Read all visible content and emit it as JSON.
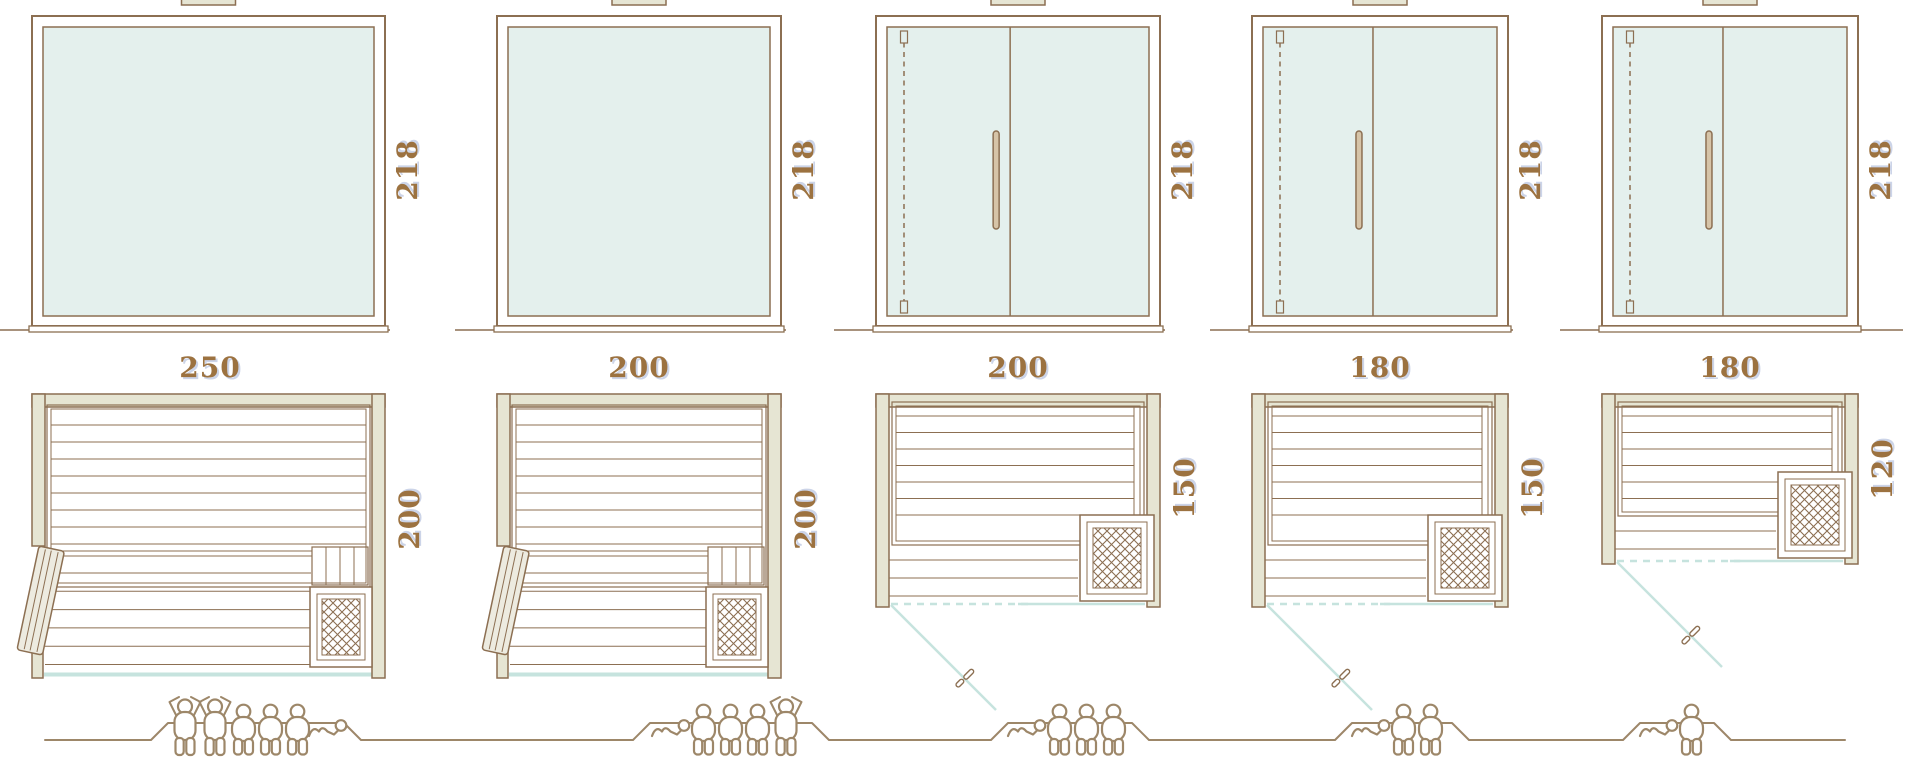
{
  "diagram": {
    "kind": "sauna size and capacity comparison sheet",
    "rows": [
      "front elevation",
      "floor plan",
      "capacity pictograms"
    ]
  },
  "colors": {
    "line_brown": "#8c6f52",
    "wall_fill": "#e6e5d3",
    "glass_fill": "#e4f0ed",
    "glass_plan_line": "#c6e3de",
    "people_outline": "#9d8769",
    "label_text": "#9c7240",
    "handle_fill": "#d6c4a8"
  },
  "saunas": [
    {
      "width": "250",
      "height": "218",
      "depth": "200",
      "front_type": "fixed glass front, side-hinged door in plan",
      "capacity_standing": 2,
      "capacity_seated": 3,
      "capacity_lying": 1,
      "capacity_total": 6
    },
    {
      "width": "200",
      "height": "218",
      "depth": "200",
      "front_type": "fixed glass front, side-hinged door in plan",
      "capacity_standing": 1,
      "capacity_seated": 3,
      "capacity_lying": 1,
      "capacity_total": 5
    },
    {
      "width": "200",
      "height": "218",
      "depth": "150",
      "front_type": "glass front with hinged glass door",
      "capacity_standing": 0,
      "capacity_seated": 3,
      "capacity_lying": 1,
      "capacity_total": 4
    },
    {
      "width": "180",
      "height": "218",
      "depth": "150",
      "front_type": "glass front with hinged glass door",
      "capacity_standing": 0,
      "capacity_seated": 2,
      "capacity_lying": 1,
      "capacity_total": 3
    },
    {
      "width": "180",
      "height": "218",
      "depth": "120",
      "front_type": "glass front with hinged glass door",
      "capacity_standing": 0,
      "capacity_seated": 1,
      "capacity_lying": 1,
      "capacity_total": 2
    }
  ]
}
